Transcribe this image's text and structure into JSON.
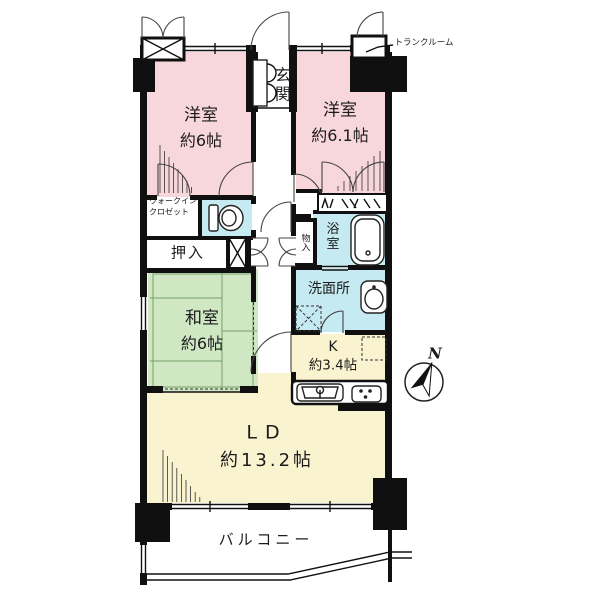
{
  "colors": {
    "wall": "#101010",
    "room_pink": "#f8d7dc",
    "room_green": "#cfe7c3",
    "room_yellow": "#faf3d0",
    "room_cyan": "#c6eaf2",
    "background": "#ffffff"
  },
  "labels": {
    "entrance": "玄関",
    "western1_name": "洋室",
    "western1_size": "約6帖",
    "western2_name": "洋室",
    "western2_size": "約6.1帖",
    "wic_line1": "ウォークイン",
    "wic_line2": "クロゼット",
    "oshiire": "押入",
    "washitsu_name": "和室",
    "washitsu_size": "約6帖",
    "monoire": "物入",
    "bath": "浴室",
    "washroom": "洗面所",
    "kitchen_name": "K",
    "kitchen_size": "約3.4帖",
    "living_name": "LD",
    "living_size": "約13.2帖",
    "balcony": "バルコニー",
    "trunk": "トランクルーム",
    "compass_n": "N"
  }
}
